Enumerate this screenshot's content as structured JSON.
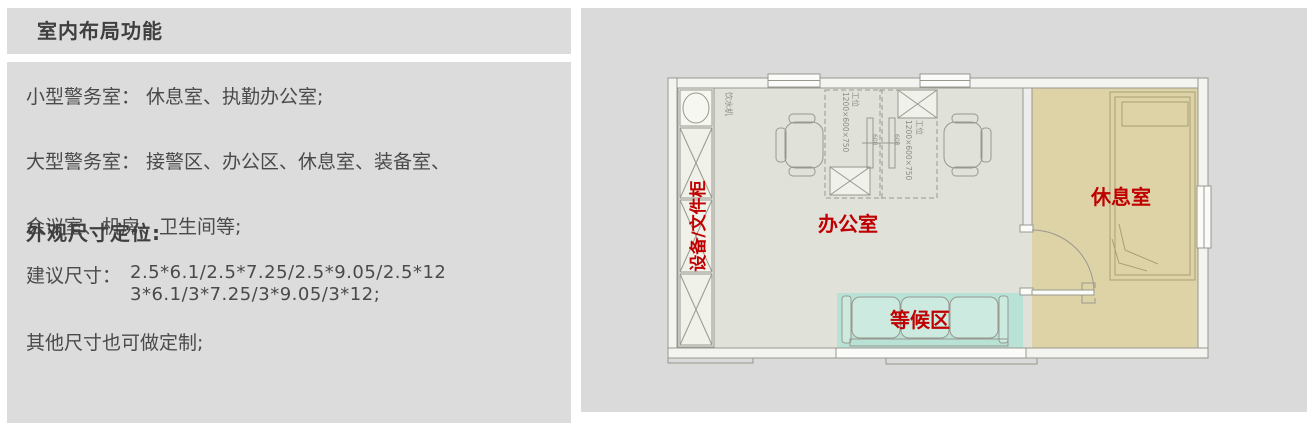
{
  "left_panel": {
    "title": "室内布局功能",
    "lines": [
      "小型警务室： 休息室、执勤办公室;",
      "大型警务室： 接警区、办公区、休息室、装备室、",
      "会议室、机房、卫生间等;"
    ],
    "size_heading": "外观尺寸定位:",
    "size_label": "建议尺寸：",
    "size_line1": "2.5*6.1/2.5*7.25/2.5*9.05/2.5*12",
    "size_line2": "3*6.1/3*7.25/3*9.05/3*12;",
    "note": "其他尺寸也可做定制;"
  },
  "floor_plan": {
    "labels": {
      "cabinet": "设备/文件柜",
      "office": "办公室",
      "rest_room": "休息室",
      "waiting_area": "等候区",
      "water_dispenser": "饮水机",
      "workstation": "工位",
      "workstation_dims": "1200×600×750",
      "monitor_size": "600"
    },
    "colors": {
      "panel_bg": "#dadada",
      "floor": "#e0e2da",
      "rest_room_fill": "#ded3a6",
      "waiting_fill": "#b9e2d7",
      "sofa_fill": "#cdeae0",
      "wall_fill": "#f3f3f0",
      "line": "#98988f",
      "label_red": "#c00000",
      "text": "#3f3f3f"
    }
  }
}
